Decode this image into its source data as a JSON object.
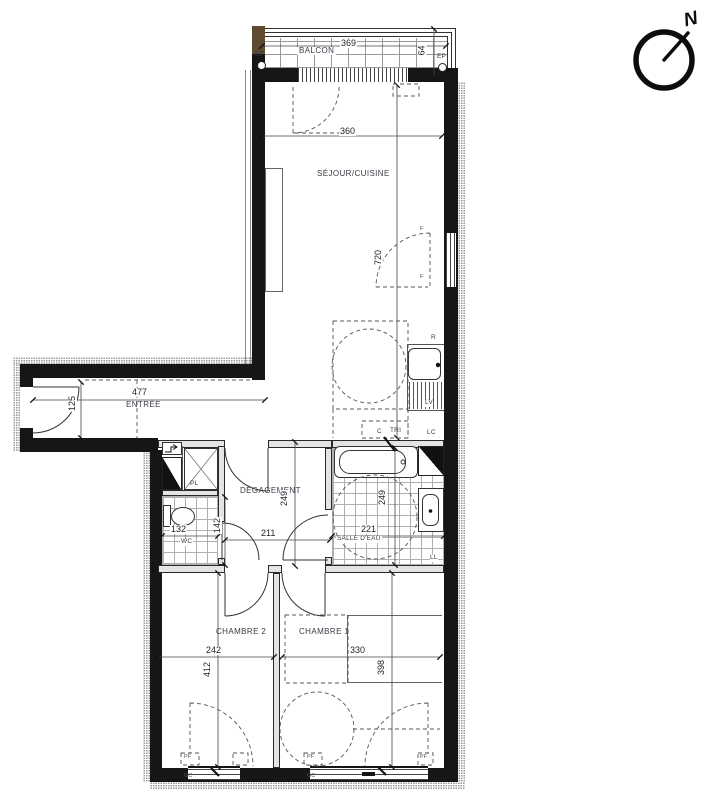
{
  "compass": {
    "north": "N"
  },
  "rooms": {
    "balcon": "BALCON",
    "sejour_cuisine": "SÉJOUR/CUISINE",
    "entree": "ENTRÉE",
    "degagement": "DÉGAGEMENT",
    "placard": "PL",
    "wc": "WC",
    "salle_eau": "SALLE D'EAU",
    "chambre1": "CHAMBRE 1",
    "chambre2": "CHAMBRE 2"
  },
  "dims": {
    "balcon_w": "369",
    "balcon_d": "64",
    "sejour_w": "360",
    "sejour_l": "720",
    "entree_w": "477",
    "entree_d": "125",
    "wc_w": "132",
    "wc_d": "142",
    "degagement_w": "211",
    "degagement_d": "249",
    "salle_eau_w": "221",
    "salle_eau_d": "249",
    "chambre2_w": "242",
    "chambre2_d": "412",
    "chambre1_w": "330",
    "chambre1_d": "398"
  },
  "annotations": {
    "ep": "EP",
    "fridge": "R",
    "lave_vaisselle": "LV",
    "lave_linge": "LL",
    "lc": "LC",
    "c": "C",
    "tri": "TRI",
    "fenetre": "F",
    "porte_fenetre": "PF",
    "garde_corps": "GC"
  }
}
